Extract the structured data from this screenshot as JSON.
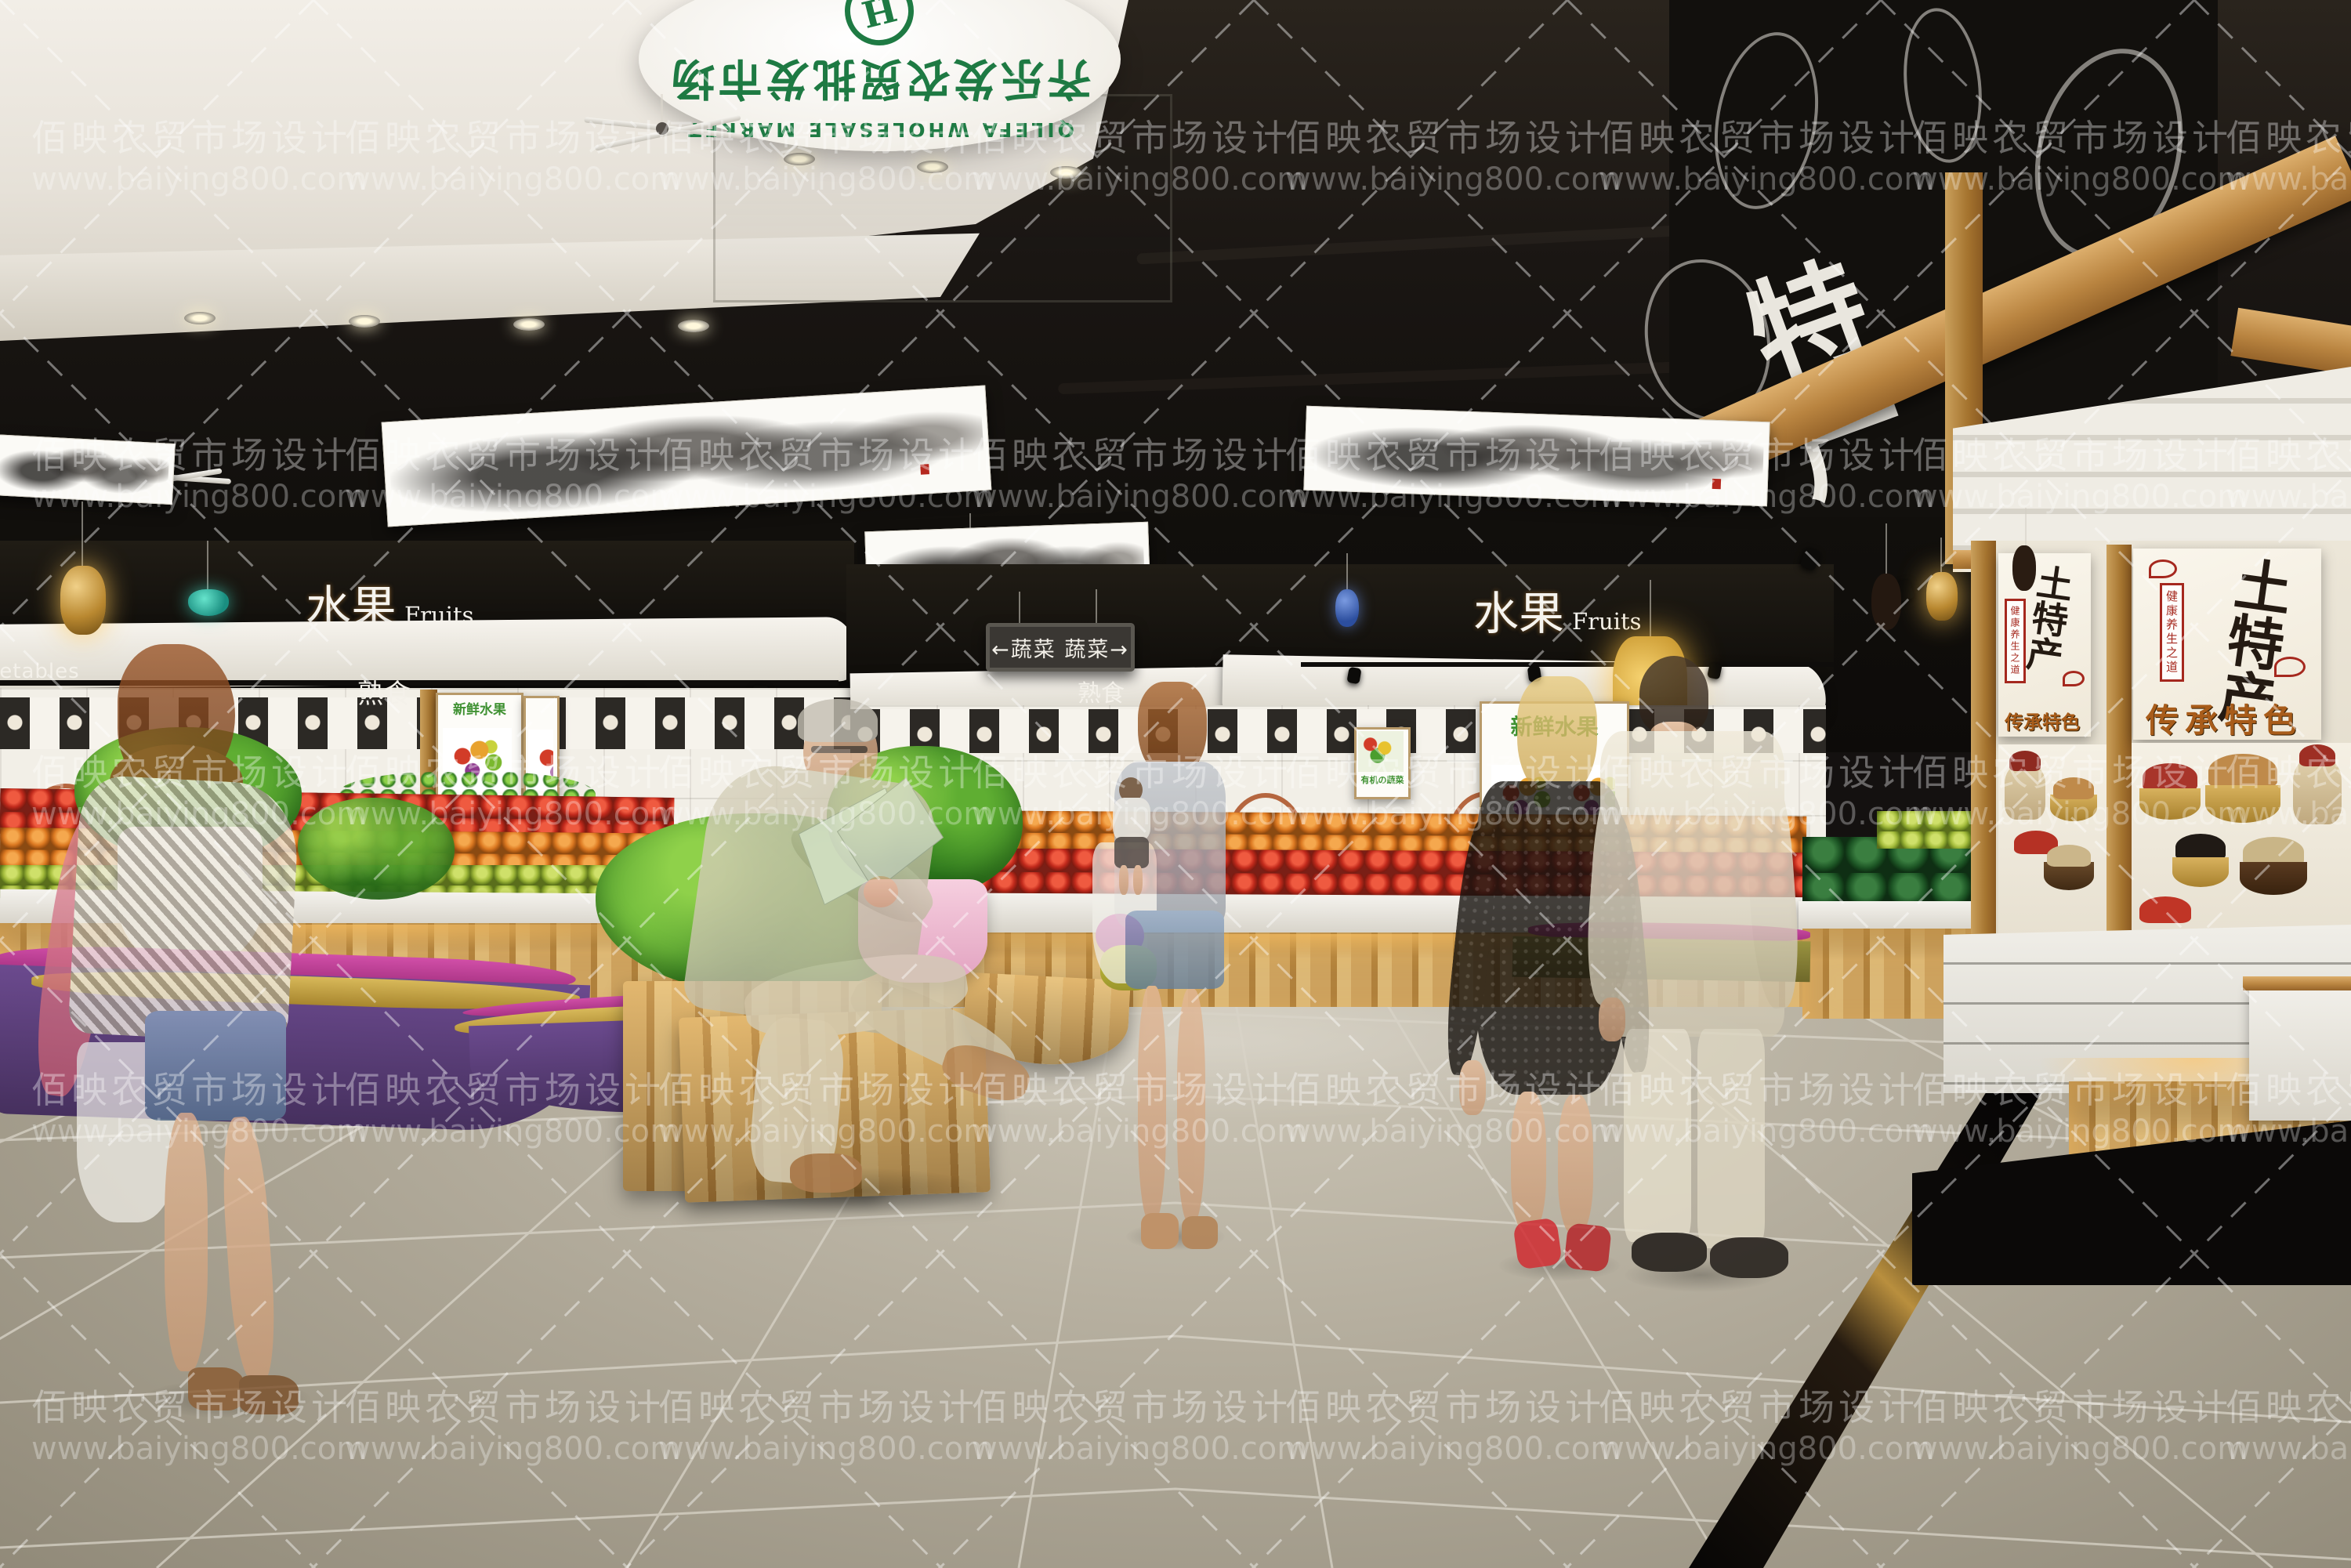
{
  "watermark": {
    "line1": "佰映农贸市场设计",
    "line2": "www.baiying800.com"
  },
  "ceiling_logo": {
    "chinese": "齐乐发农贸批发市场",
    "english": "QILEFA WHOLESALE MARKET",
    "emblem_letter": "H"
  },
  "signs": {
    "fruits_cn": "水果",
    "fruits_en": "Fruits",
    "vegetables_hanging": "←蔬菜 蔬菜→",
    "cooked_food": "熟食",
    "specialty_wall": "特产",
    "vegetables_partial": "Vegetables"
  },
  "posters": {
    "fresh_fruit_title": "新鲜水果",
    "organic_veg_title": "有机の蔬菜",
    "specialty_title": "土特产",
    "specialty_side_label": "健康养生之道",
    "specialty_bottom": "传承特色"
  },
  "palette": {
    "logo_green": "#1e7a43",
    "arch_brown": "#b5663f",
    "ceiling_white": "#eae6df",
    "ceiling_black": "#16130f",
    "wood": "#c08a4a",
    "produce_red": "#d8352c",
    "produce_orange": "#e07a28",
    "produce_green": "#9ec23e",
    "watermelon_green": "#1e5c2a",
    "bench_purple": "#5a3d7d",
    "bench_magenta": "#c23d98",
    "bench_gold": "#c0a246",
    "floor_gray": "#a8a191",
    "poster_red": "#a5281e",
    "poster_orange": "#c4761f",
    "lantern_amber": "#c9962e",
    "pendant_teal": "#1fae9b",
    "heels_red": "#d1232a"
  }
}
